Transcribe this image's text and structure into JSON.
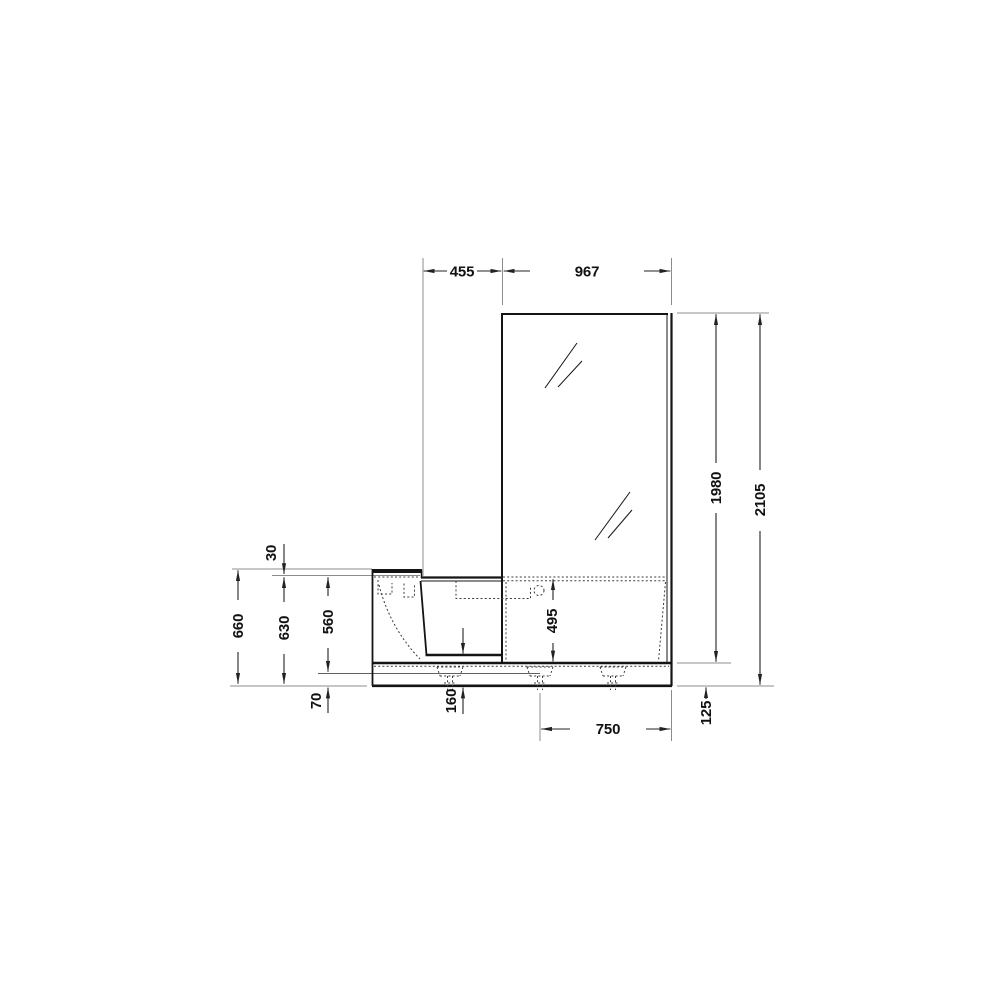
{
  "drawing": {
    "type": "technical-elevation",
    "subject": "walk-in bathtub with shower screen",
    "background": "#ffffff",
    "colors": {
      "outline": "#141414",
      "dimension_line": "#222222",
      "extension_line": "#8c8c8c",
      "hidden_line": "#3c3c3c",
      "text": "#111111"
    },
    "dimensions": {
      "top": [
        "455",
        "967"
      ],
      "right": [
        "1980",
        "2105",
        "125"
      ],
      "left": [
        "30",
        "660",
        "630",
        "560",
        "70"
      ],
      "bottom": [
        "160",
        "495",
        "750"
      ]
    }
  }
}
